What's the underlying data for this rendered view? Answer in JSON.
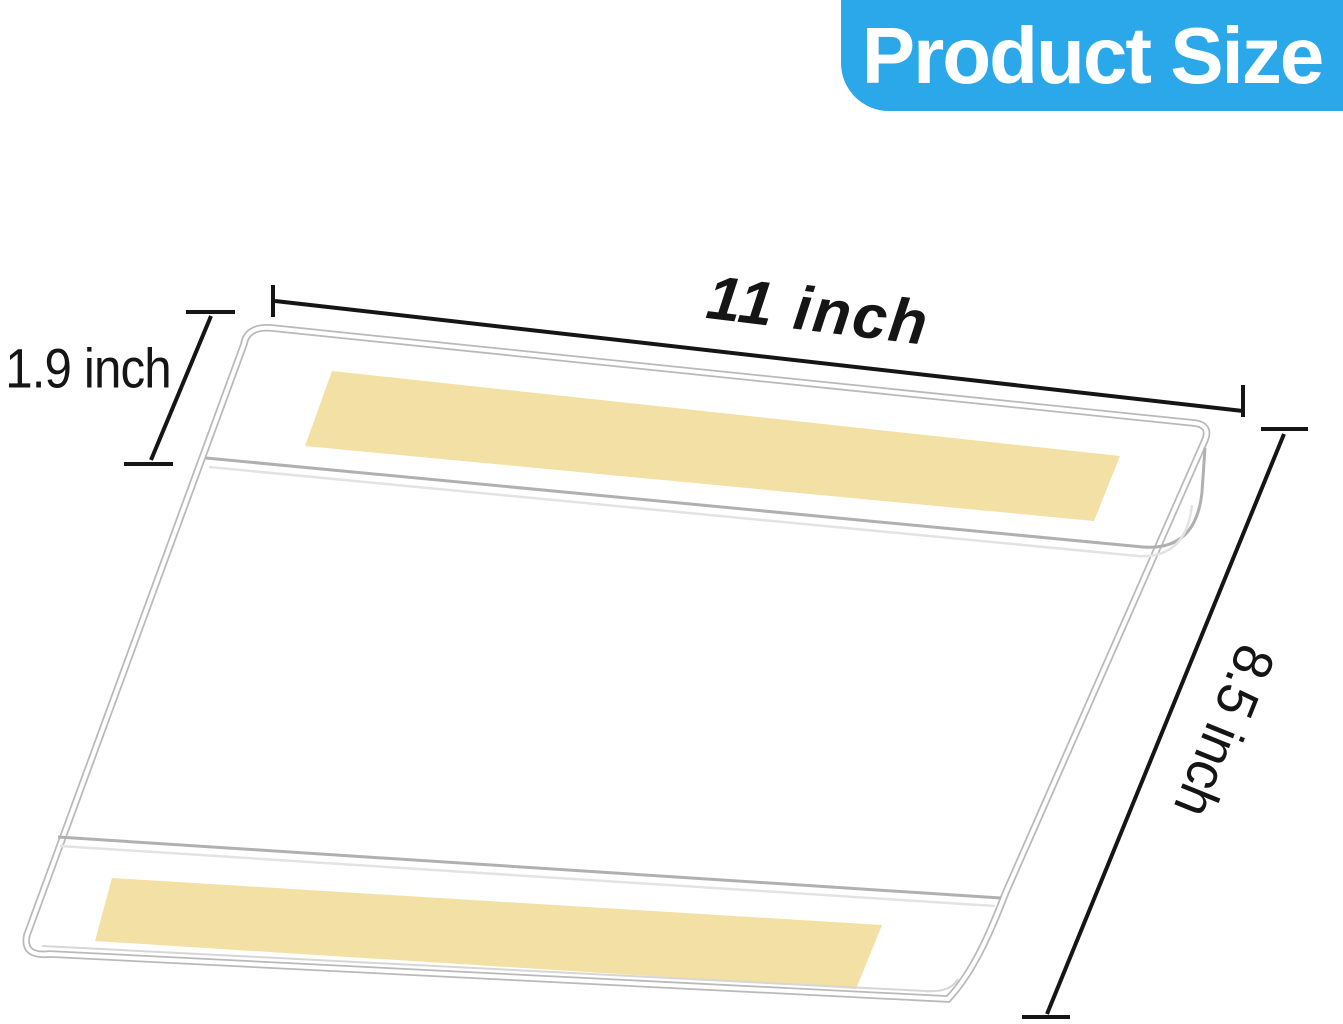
{
  "banner": {
    "label": "Product Size"
  },
  "diagram": {
    "dimensions": {
      "width": {
        "label": "11 inch"
      },
      "pocket": {
        "label": "1.9 inch"
      },
      "height": {
        "label": "8.5 inch"
      }
    }
  },
  "colors": {
    "accent": "#2AA8E9",
    "banner_text": "#FFFFFF",
    "strip": "#F3E0A5",
    "ink": "#151515",
    "edge": "#B9B9B9",
    "edge_light": "#E3E3E3",
    "paper": "#FFFFFF"
  }
}
